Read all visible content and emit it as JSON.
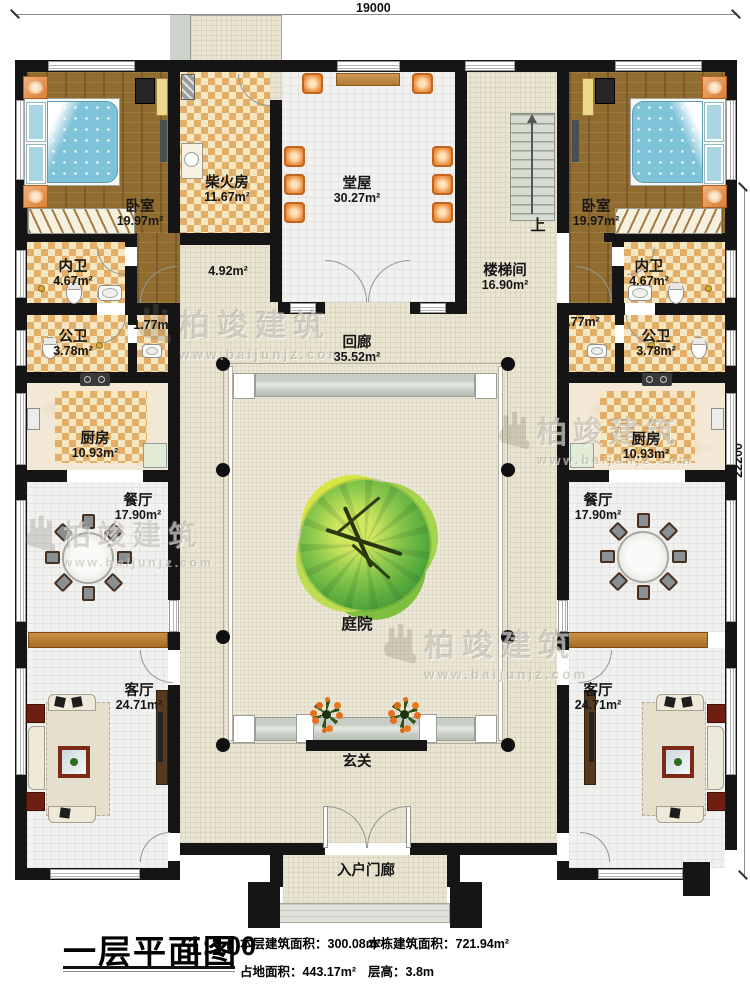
{
  "dimensions": {
    "top": "19000",
    "right": "22200"
  },
  "rooms": {
    "bedroom_left": {
      "name": "卧室",
      "area": "19.97m²"
    },
    "bedroom_right": {
      "name": "卧室",
      "area": "19.97m²"
    },
    "firewood": {
      "name": "柴火房",
      "area": "11.67m²"
    },
    "hall": {
      "name": "堂屋",
      "area": "30.27m²"
    },
    "stairwell": {
      "name": "楼梯间",
      "area": "16.90m²"
    },
    "stairs_up": {
      "label": "上"
    },
    "inner_bath_left": {
      "name": "内卫",
      "area": "4.67m²"
    },
    "inner_bath_right": {
      "name": "内卫",
      "area": "4.67m²"
    },
    "public_bath_left": {
      "name": "公卫",
      "area": "3.78m²"
    },
    "public_bath_right": {
      "name": "公卫",
      "area": "3.78m²"
    },
    "pass_left": {
      "area": "1.77m²"
    },
    "pass_right": {
      "area": "1.77m²"
    },
    "pass_center": {
      "area": "4.92m²"
    },
    "cloister": {
      "name": "回廊",
      "area": "35.52m²"
    },
    "kitchen_left": {
      "name": "厨房",
      "area": "10.93m²"
    },
    "kitchen_right": {
      "name": "厨房",
      "area": "10.93m²"
    },
    "dining_left": {
      "name": "餐厅",
      "area": "17.90m²"
    },
    "dining_right": {
      "name": "餐厅",
      "area": "17.90m²"
    },
    "courtyard": {
      "name": "庭院"
    },
    "living_left": {
      "name": "客厅",
      "area": "24.71m²"
    },
    "living_right": {
      "name": "客厅",
      "area": "24.71m²"
    },
    "foyer": {
      "name": "玄关"
    },
    "porch": {
      "name": "入户门廊"
    }
  },
  "footer": {
    "title": "一层平面图",
    "scale": "1:100",
    "stats": [
      {
        "label": "本层建筑面积：",
        "value": "300.08m²"
      },
      {
        "label": "本栋建筑面积：",
        "value": "721.94m²"
      },
      {
        "label": "占地面积：",
        "value": "443.17m²"
      },
      {
        "label": "层高：",
        "value": "3.8m"
      }
    ]
  },
  "watermark": {
    "brand": "柏竣建筑",
    "url": "www.baijunjz.com"
  },
  "colors": {
    "wall": "#151515",
    "floor_beige": "#eae5d2",
    "floor_tile": "#f1f1ef",
    "floor_wood": "#916c30",
    "checker": "#e3af68",
    "accent_orange": "#e8954a",
    "tree_green": "#4da33c",
    "band_grey": "#ccd3ca"
  }
}
